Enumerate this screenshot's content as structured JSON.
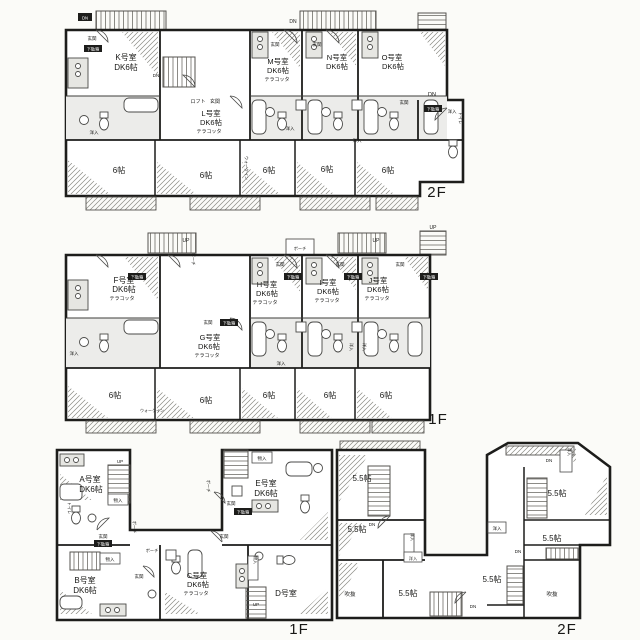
{
  "document": {
    "kind": "apartment-floor-plan-drawing",
    "background": "#fbfbf8",
    "wall_color": "#1d1d1b"
  },
  "labels": {
    "up": "UP",
    "dn": "DN",
    "genkan": "玄関",
    "porch": "ポーチ",
    "loft": "ロフト",
    "closet": "洋入",
    "storage": "物入",
    "toilet": "トイレ",
    "shoebox": "下駄箱",
    "walkin": "ウォークイン",
    "void": "吹抜"
  },
  "building_a_2f": {
    "floor_label": "2F",
    "units": [
      {
        "name": "K号室",
        "size": "DK6帖",
        "note": ""
      },
      {
        "name": "L号室",
        "size": "DK6帖",
        "note": "テラコッタ"
      },
      {
        "name": "M号室",
        "size": "DK6帖",
        "note": "テラコッタ"
      },
      {
        "name": "N号室",
        "size": "DK6帖",
        "note": ""
      },
      {
        "name": "O号室",
        "size": "DK6帖",
        "note": ""
      }
    ],
    "rooms": [
      "6帖",
      "6帖",
      "6帖",
      "6帖",
      "6帖"
    ]
  },
  "building_a_1f": {
    "floor_label": "1F",
    "units": [
      {
        "name": "F号室",
        "size": "DK6帖",
        "note": "テラコッタ"
      },
      {
        "name": "G号室",
        "size": "DK6帖",
        "note": "テラコッタ"
      },
      {
        "name": "H号室",
        "size": "DK6帖",
        "note": "テラコッタ"
      },
      {
        "name": "I号室",
        "size": "DK6帖",
        "note": "テラコッタ"
      },
      {
        "name": "J号室",
        "size": "DK6帖",
        "note": "テラコッタ"
      }
    ],
    "rooms": [
      "6帖",
      "6帖",
      "6帖",
      "6帖",
      "6帖"
    ]
  },
  "building_b_1f": {
    "floor_label": "1F",
    "units": [
      {
        "name": "A号室",
        "size": "DK6帖",
        "note": ""
      },
      {
        "name": "B号室",
        "size": "DK6帖",
        "note": ""
      },
      {
        "name": "C号室",
        "size": "DK6帖",
        "note": "テラコッタ"
      },
      {
        "name": "D号室",
        "size": "",
        "note": ""
      },
      {
        "name": "E号室",
        "size": "DK6帖",
        "note": ""
      }
    ]
  },
  "building_b_2f": {
    "floor_label": "2F",
    "rooms": [
      "5.5帖",
      "5.5帖",
      "5.5帖",
      "5.5帖",
      "5.5帖",
      "5.5帖"
    ],
    "voids": [
      "吹抜",
      "吹抜"
    ]
  }
}
